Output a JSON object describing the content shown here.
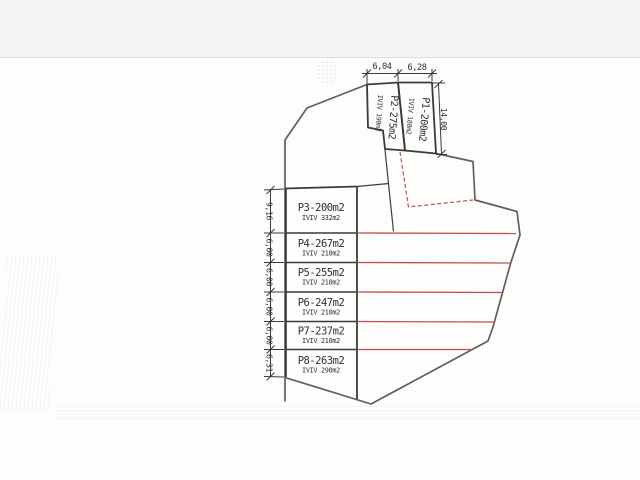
{
  "drawing": {
    "top_parcels": [
      {
        "label": "P2-275m2",
        "sublabel": "IVIV 190m2"
      },
      {
        "label": "P1-200m2",
        "sublabel": "IVIV 180m2"
      }
    ],
    "table_parcels": [
      {
        "label": "P3-200m2",
        "sublabel": "IVIV 332m2",
        "side_dim": "9,16"
      },
      {
        "label": "P4-267m2",
        "sublabel": "IVIV 210m2",
        "side_dim": "6,00"
      },
      {
        "label": "P5-255m2",
        "sublabel": "IVIV 210m2",
        "side_dim": "6,00"
      },
      {
        "label": "P6-247m2",
        "sublabel": "IVIV 210m2",
        "side_dim": "6,00"
      },
      {
        "label": "P7-237m2",
        "sublabel": "IVIV 210m2",
        "side_dim": "6,00"
      },
      {
        "label": "P8-263m2",
        "sublabel": "IVIV 290m2",
        "side_dim": "6,31"
      }
    ],
    "top_dims": [
      "6,04",
      "6,28"
    ],
    "right_dim": "14,00",
    "colors": {
      "line": "#3a3a3a",
      "boundary": "#5f5f5f",
      "red": "#c0504d"
    }
  }
}
